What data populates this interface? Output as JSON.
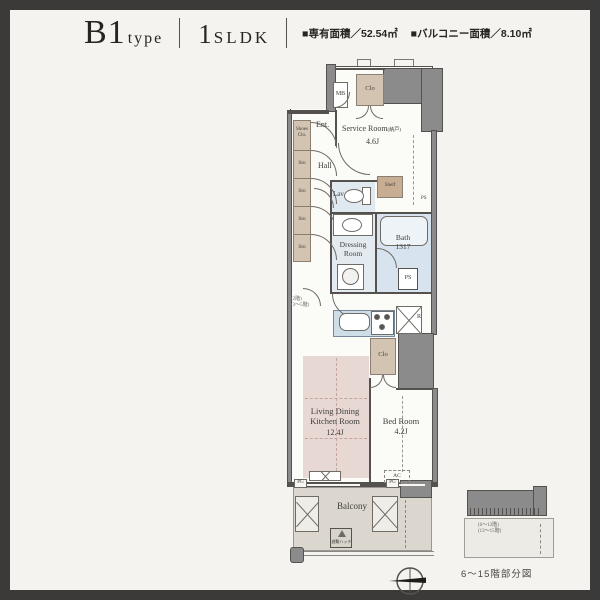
{
  "header": {
    "type_main": "B1",
    "type_suffix": "type",
    "layout_number": "1",
    "layout_letters": "SLDK",
    "area_exclusive": "■専有面積／52.54㎡",
    "area_balcony": "■バルコニー面積／8.10㎡"
  },
  "rooms": {
    "service_room": "Service Room",
    "service_room_note": "(納戸)",
    "service_room_size": "4.6J",
    "entrance": "Ent.",
    "hall": "Hall",
    "lavatory": "Lav",
    "dressing_line1": "Dressing",
    "dressing_line2": "Room",
    "bath": "Bath",
    "bath_size": "1317",
    "ldk_line1": "Living Dining",
    "ldk_line2": "Kitchen Room",
    "ldk_size": "12.4J",
    "bedroom": "Bed Room",
    "bedroom_size": "4.2J",
    "balcony": "Balcony"
  },
  "fixtures": {
    "meter_box": "MB",
    "entry_closet": "Clo",
    "shoes_closet_line1": "Shoes",
    "shoes_closet_line2": "Clo.",
    "storage": "Sto",
    "shelf": "Shelf",
    "pipe_space": "PS",
    "pipe_gutter": "PG",
    "refrigerator": "R",
    "mid_closet": "Clo",
    "air_conditioner": "AC",
    "evacuation_hatch": "避難ハッチ"
  },
  "notes": {
    "floor_line1": "(2階)",
    "floor_line2": "(3〜5階)",
    "inset_line1": "(6〜12階)",
    "inset_line2": "(13〜15階)",
    "inset_caption": "6〜15階部分図"
  },
  "colors": {
    "frame": "#3b3a38",
    "page_bg": "#f4f3ef",
    "wall_gray": "#8b8b8b",
    "line_dark": "#55514e",
    "ldk_pink": "#e8d8d4",
    "wet_blue": "#d7e3ee",
    "closet_beige": "#d3c4b1",
    "balcony_gray": "#dbd7ce"
  }
}
